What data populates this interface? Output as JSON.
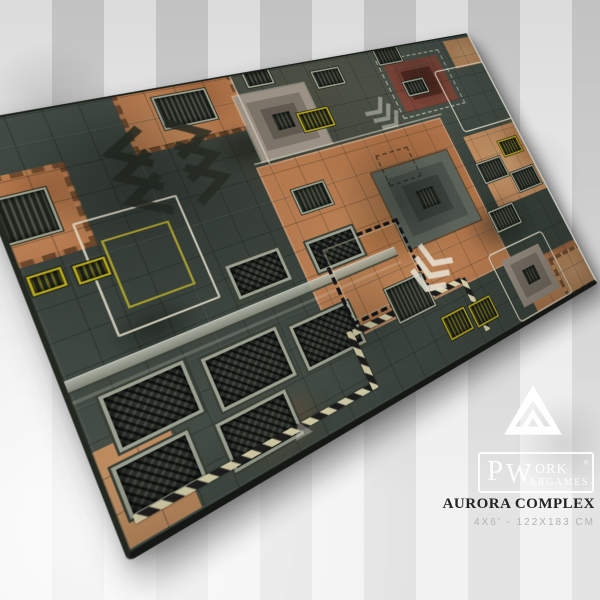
{
  "product": {
    "title": "AURORA COMPLEX",
    "size": "4x6' - 122x183 cm"
  },
  "brand": {
    "p": "P",
    "w": "W",
    "ork": "ORK",
    "registered": "®",
    "argames": "ARGAMES"
  },
  "icons": {
    "triangle_logo": "pwork-triangle-logo",
    "mat_watermark": "triangle-watermark"
  },
  "colors": {
    "backdrop": "#d6d6d6",
    "stripe_light": "#e3e3e3",
    "mat_green": "#47524a",
    "mat_green_dark": "#343d36",
    "rust": "#b5794e",
    "rust_light": "#c89a6e",
    "maroon": "#7c4538",
    "vent_dark": "#1f241d",
    "metal": "#9aa08e",
    "hazard_yellow": "#b3a41c",
    "hazard_ivory": "#d9d2ac",
    "hazard_black": "#1c1c1c",
    "marking_cream": "#e8e4d0",
    "title_text": "#232323",
    "size_text": "#b3b3b3",
    "logo_white": "#ffffff"
  }
}
